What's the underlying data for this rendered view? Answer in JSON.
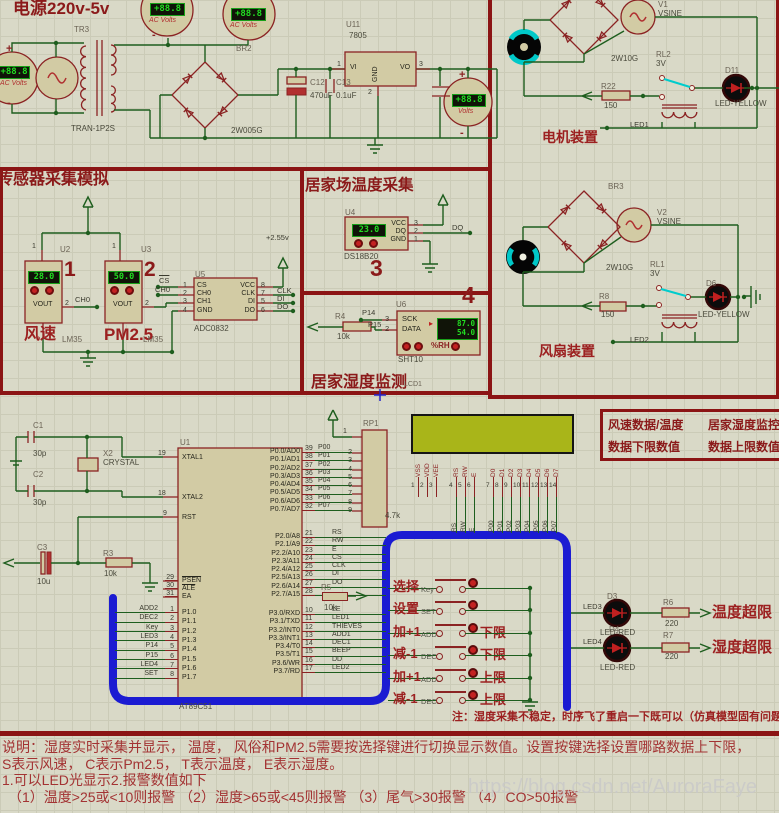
{
  "power": {
    "title": "电源220v-5v",
    "tr_ref": "TR3",
    "tr_val": "TRAN-1P2S",
    "meter_reading": "+88.8",
    "meter_type_ac": "AC Volts",
    "meter_type_dc": "Volts",
    "plus": "+",
    "minus": "-",
    "br_ref": "BR2",
    "br_val": "2W005G",
    "reg_ref": "U11",
    "reg_val": "7805",
    "reg_pins": {
      "vi": "VI",
      "vo": "VO",
      "gnd": "GND",
      "p1": "1",
      "p2": "2",
      "p3": "3"
    },
    "c12_ref": "C12",
    "c12_val": "470uF",
    "c13_ref": "C13",
    "c13_val": "0.1uF"
  },
  "motor": {
    "v_ref": "V1",
    "v_val": "VSINE",
    "br_val": "2W10G",
    "relay_ref": "RL2",
    "relay_val": "3V",
    "r_ref": "R22",
    "r_val": "150",
    "led_ref": "D11",
    "led_val": "LED-YELLOW",
    "coil_net": "LED1",
    "caption": "电机装置"
  },
  "fan": {
    "br_ref": "BR3",
    "v_ref": "V2",
    "v_val": "VSINE",
    "br_val": "2W10G",
    "relay_ref": "RL1",
    "relay_val": "3V",
    "r_ref": "R8",
    "r_val": "150",
    "led_ref": "D6",
    "led_val": "LED-YELLOW",
    "coil_net": "LED2",
    "caption": "风扇装置"
  },
  "sensors": {
    "title": "传感器采集模拟",
    "vref": "+2.55v",
    "wind": {
      "ref": "U2",
      "num": "1",
      "reading": "28.0",
      "pin1": "1",
      "pin2": "2",
      "pin_label": "VOUT",
      "net": "CH0",
      "name": "风速",
      "part": "LM35"
    },
    "pm": {
      "ref": "U3",
      "num": "2",
      "reading": "50.0",
      "pin1": "1",
      "pin2": "2",
      "pin_label": "VOUT",
      "name": "PM2.5",
      "part": "LM35"
    },
    "adc": {
      "ref": "U5",
      "part": "ADC0832",
      "left_pins": [
        {
          "name": "CS",
          "num": "1"
        },
        {
          "name": "CH0",
          "num": "2"
        },
        {
          "name": "CH1",
          "num": "3"
        },
        {
          "name": "GND",
          "num": "4"
        }
      ],
      "right_pins": [
        {
          "name": "VCC",
          "num": "8"
        },
        {
          "name": "CLK",
          "num": "7"
        },
        {
          "name": "DI",
          "num": "5"
        },
        {
          "name": "DO",
          "num": "6"
        }
      ],
      "net_cs": "CS",
      "net_ch0": "CH0",
      "net_clk": "CLK",
      "net_di": "DI",
      "net_do": "DO"
    }
  },
  "temp": {
    "title": "居家场温度采集",
    "ref": "U4",
    "part": "DS18B20",
    "reading": "23.0",
    "num": "3",
    "pins": [
      {
        "name": "VCC",
        "num": "3"
      },
      {
        "name": "DQ",
        "num": "2"
      },
      {
        "name": "GND",
        "num": "1"
      }
    ],
    "net": "DQ"
  },
  "humidity": {
    "ref": "U6",
    "part": "SHT10",
    "num": "4",
    "reading_top": "87.0",
    "reading_bottom": "54.0",
    "unit": "%RH",
    "pointer": "▸",
    "pins": [
      {
        "name": "SCK",
        "num": "3",
        "net": "P14"
      },
      {
        "name": "DATA",
        "num": "2",
        "net": "P15"
      }
    ],
    "r_ref": "R4",
    "r_val": "10k",
    "title": "居家湿度监测",
    "lcd_ref": "LCD1"
  },
  "mcu": {
    "ref": "U1",
    "part": "AT89C51",
    "xtal": {
      "c1_ref": "C1",
      "c1_val": "30p",
      "c2_ref": "C2",
      "c2_val": "30p",
      "x_ref": "X2",
      "x_val": "CRYSTAL"
    },
    "reset": {
      "c_ref": "C3",
      "c_val": "10u",
      "r_ref": "R3",
      "r_val": "10k"
    },
    "left_top": [
      {
        "name": "XTAL1",
        "num": "19"
      },
      {
        "name": "XTAL2",
        "num": "18"
      },
      {
        "name": "RST",
        "num": "9"
      }
    ],
    "left_ctl": [
      {
        "name": "PSEN",
        "num": "29"
      },
      {
        "name": "ALE",
        "num": "30"
      },
      {
        "name": "EA",
        "num": "31"
      }
    ],
    "p1": [
      {
        "name": "P1.0",
        "num": "1",
        "net": "ADD2"
      },
      {
        "name": "P1.1",
        "num": "2",
        "net": "DEC2"
      },
      {
        "name": "P1.2",
        "num": "3",
        "net": "Key"
      },
      {
        "name": "P1.3",
        "num": "4",
        "net": "LED3"
      },
      {
        "name": "P1.4",
        "num": "5",
        "net": "P14"
      },
      {
        "name": "P1.5",
        "num": "6",
        "net": "P15"
      },
      {
        "name": "P1.6",
        "num": "7",
        "net": "LED4"
      },
      {
        "name": "P1.7",
        "num": "8",
        "net": "SET"
      }
    ],
    "p0": [
      {
        "name": "P0.0/AD0",
        "num": "39",
        "net": "P00"
      },
      {
        "name": "P0.1/AD1",
        "num": "38",
        "net": "P01"
      },
      {
        "name": "P0.2/AD2",
        "num": "37",
        "net": "P02"
      },
      {
        "name": "P0.3/AD3",
        "num": "36",
        "net": "P03"
      },
      {
        "name": "P0.4/AD4",
        "num": "35",
        "net": "P04"
      },
      {
        "name": "P0.5/AD5",
        "num": "34",
        "net": "P05"
      },
      {
        "name": "P0.6/AD6",
        "num": "33",
        "net": "P06"
      },
      {
        "name": "P0.7/AD7",
        "num": "32",
        "net": "P07"
      }
    ],
    "p2": [
      {
        "name": "P2.0/A8",
        "num": "21",
        "net": "RS"
      },
      {
        "name": "P2.1/A9",
        "num": "22",
        "net": "RW"
      },
      {
        "name": "P2.2/A10",
        "num": "23",
        "net": "E"
      },
      {
        "name": "P2.3/A11",
        "num": "24",
        "net": "CS"
      },
      {
        "name": "P2.4/A12",
        "num": "25",
        "net": "CLK"
      },
      {
        "name": "P2.5/A13",
        "num": "26",
        "net": "DI"
      },
      {
        "name": "P2.6/A14",
        "num": "27",
        "net": "DO"
      },
      {
        "name": "P2.7/A15",
        "num": "28",
        "net": ""
      }
    ],
    "p3": [
      {
        "name": "P3.0/RXD",
        "num": "10",
        "net": "LE"
      },
      {
        "name": "P3.1/TXD",
        "num": "11",
        "net": "LED1"
      },
      {
        "name": "P3.2/INT0",
        "num": "12",
        "net": "THIEVES"
      },
      {
        "name": "P3.3/INT1",
        "num": "13",
        "net": "ADD1"
      },
      {
        "name": "P3.4/T0",
        "num": "14",
        "net": "DEC1"
      },
      {
        "name": "P3.5/T1",
        "num": "15",
        "net": "BEEP"
      },
      {
        "name": "P3.6/WR",
        "num": "16",
        "net": "DD"
      },
      {
        "name": "P3.7/RD",
        "num": "17",
        "net": "LED2"
      }
    ],
    "rp_ref": "RP1",
    "rp_val": "4.7k",
    "rp_pin1": "1",
    "rp_pins": [
      "2",
      "3",
      "4",
      "5",
      "6",
      "7",
      "8",
      "9"
    ],
    "r5_ref": "R5",
    "r5_val": "10k"
  },
  "lcd": {
    "power_pins": [
      {
        "name": "VSS",
        "num": "1"
      },
      {
        "name": "VDD",
        "num": "2"
      },
      {
        "name": "VEE",
        "num": "3"
      }
    ],
    "ctrl_pins": [
      {
        "name": "RS",
        "num": "4",
        "net": "RS"
      },
      {
        "name": "RW",
        "num": "5",
        "net": "RW"
      },
      {
        "name": "E",
        "num": "6",
        "net": "E"
      }
    ],
    "data_pins": [
      {
        "name": "D0",
        "num": "7",
        "net": "P00"
      },
      {
        "name": "D1",
        "num": "8",
        "net": "P01"
      },
      {
        "name": "D2",
        "num": "9",
        "net": "P02"
      },
      {
        "name": "D3",
        "num": "10",
        "net": "P03"
      },
      {
        "name": "D4",
        "num": "11",
        "net": "P04"
      },
      {
        "name": "D5",
        "num": "12",
        "net": "P05"
      },
      {
        "name": "D6",
        "num": "13",
        "net": "P06"
      },
      {
        "name": "D7",
        "num": "14",
        "net": "P07"
      }
    ]
  },
  "infobox": {
    "r1c1": "风速数据/温度",
    "r1c2": "居家湿度监控",
    "r2c1": "数据下限数值",
    "r2c2": "数据上限数值"
  },
  "buttons": [
    {
      "cn": "选择",
      "net": "Key",
      "limit": ""
    },
    {
      "cn": "设置",
      "net": "SET",
      "limit": ""
    },
    {
      "cn": "加+1",
      "net": "ADD1",
      "limit": "下限"
    },
    {
      "cn": "减-1",
      "net": "DEC1",
      "limit": "下限"
    },
    {
      "cn": "加+1",
      "net": "ADD2",
      "limit": "上限"
    },
    {
      "cn": "减-1",
      "net": "DEC2",
      "limit": "上限"
    }
  ],
  "alarms": [
    {
      "net": "LED3",
      "ref": "D3",
      "part": "LED-RED",
      "r_ref": "R6",
      "r_val": "220",
      "text": "温度超限"
    },
    {
      "net": "LED4",
      "ref": "D4",
      "part": "LED-RED",
      "r_ref": "R7",
      "r_val": "220",
      "text": "湿度超限"
    }
  ],
  "notes": {
    "sim_note": "注：湿度采集不稳定，时序飞了重启一下既可以（仿真模型固有问题）",
    "line1": "说明：湿度实时采集并显示， 温度， 风俗和PM2.5需要按选择键进行切换显示数值。设置按键选择设置哪路数据上下限，",
    "line2": "S表示风速， C表示Pm2.5， T表示温度， E表示湿度。",
    "line3": "1.可以LED光显示2.报警数值如下",
    "line4": "（1）温度>25或<10则报警 （2）湿度>65或<45则报警 （3）尾气>30报警 （4）CO>50报警"
  },
  "watermark": "https://blog.csdn.net/AuroraFaye"
}
